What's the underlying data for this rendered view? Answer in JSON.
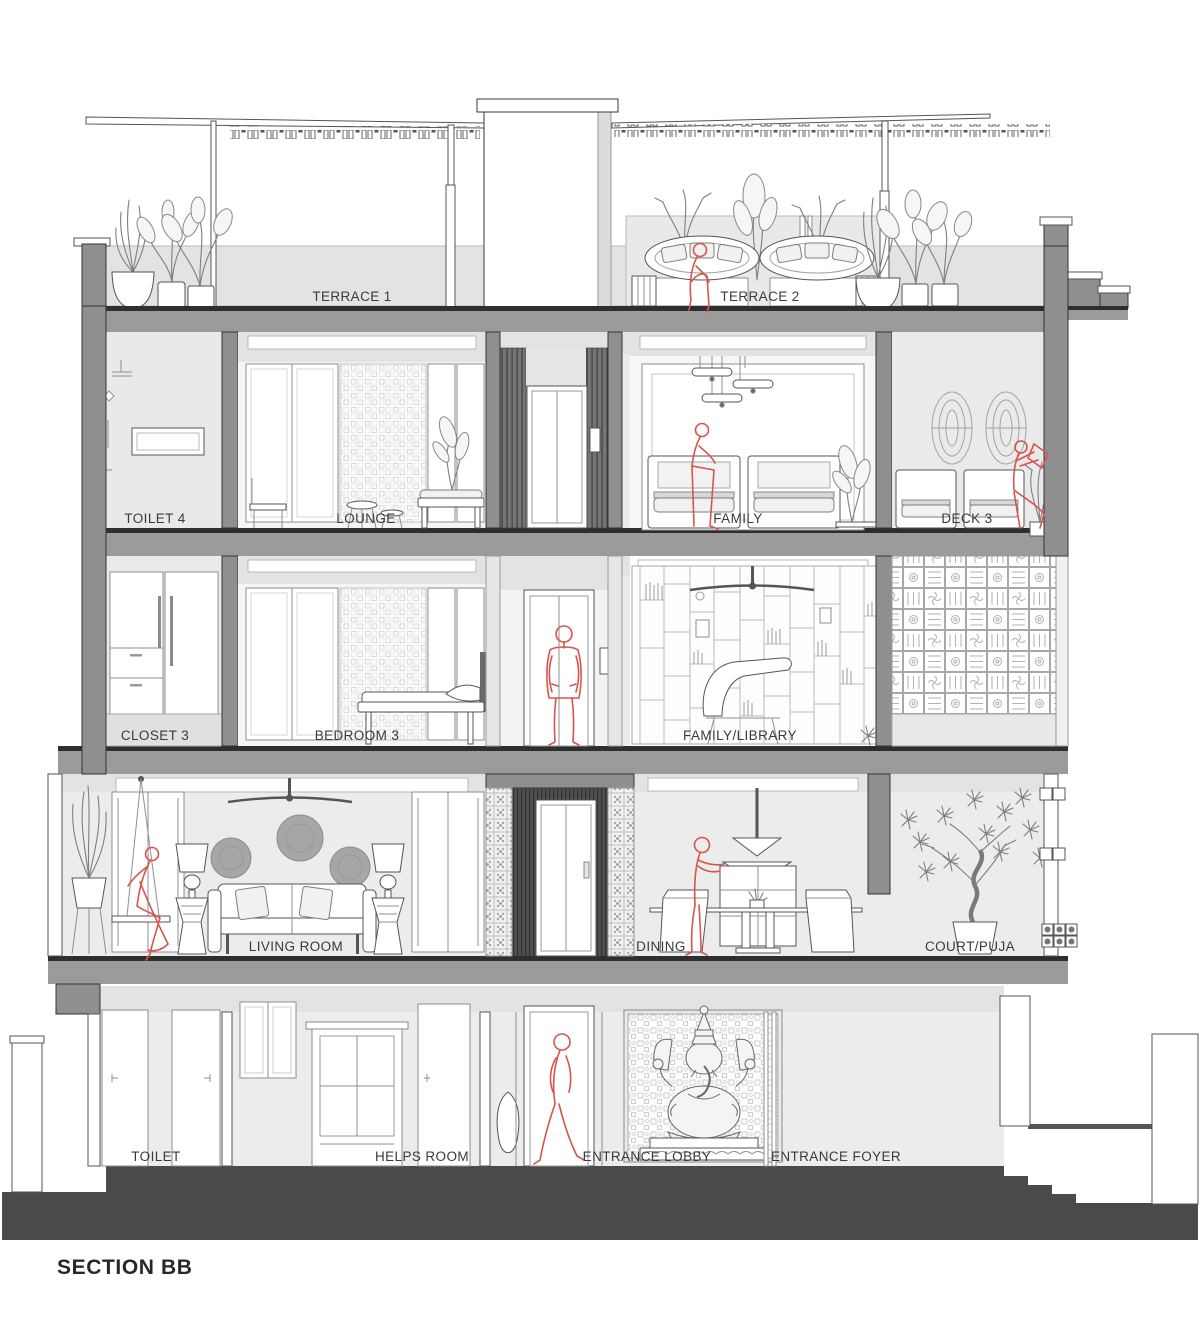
{
  "title": "SECTION BB",
  "colors": {
    "figure_red": "#d9544a",
    "slab_gray": "#9b9b9b",
    "ground_dark": "#4a4a4a",
    "wall_gray": "#8f8f8f",
    "room_light": "#ececec",
    "label_ink": "#3a3a3a"
  },
  "floors": [
    {
      "name": "terrace",
      "rooms": [
        {
          "label": "TERRACE 1"
        },
        {
          "label": "TERRACE 2"
        }
      ]
    },
    {
      "name": "third-floor",
      "rooms": [
        {
          "label": "TOILET 4"
        },
        {
          "label": "LOUNGE"
        },
        {
          "label": "FAMILY"
        },
        {
          "label": "DECK 3"
        }
      ]
    },
    {
      "name": "second-floor",
      "rooms": [
        {
          "label": "CLOSET 3"
        },
        {
          "label": "BEDROOM 3"
        },
        {
          "label": "FAMILY/LIBRARY"
        }
      ]
    },
    {
      "name": "first-floor",
      "rooms": [
        {
          "label": "LIVING ROOM"
        },
        {
          "label": "DINING"
        },
        {
          "label": "COURT/PUJA"
        }
      ]
    },
    {
      "name": "ground-floor",
      "rooms": [
        {
          "label": "TOILET"
        },
        {
          "label": "HELPS ROOM"
        },
        {
          "label": "ENTRANCE LOBBY"
        },
        {
          "label": "ENTRANCE FOYER"
        }
      ]
    }
  ],
  "figures": [
    {
      "location": "terrace-2",
      "pose": "sitting"
    },
    {
      "location": "family-3f",
      "pose": "sitting"
    },
    {
      "location": "deck-3",
      "pose": "sitting-reading"
    },
    {
      "location": "elevator-2f",
      "pose": "standing"
    },
    {
      "location": "living-room-swing",
      "pose": "sitting"
    },
    {
      "location": "dining",
      "pose": "standing"
    },
    {
      "location": "entrance-lobby",
      "pose": "walking"
    }
  ]
}
